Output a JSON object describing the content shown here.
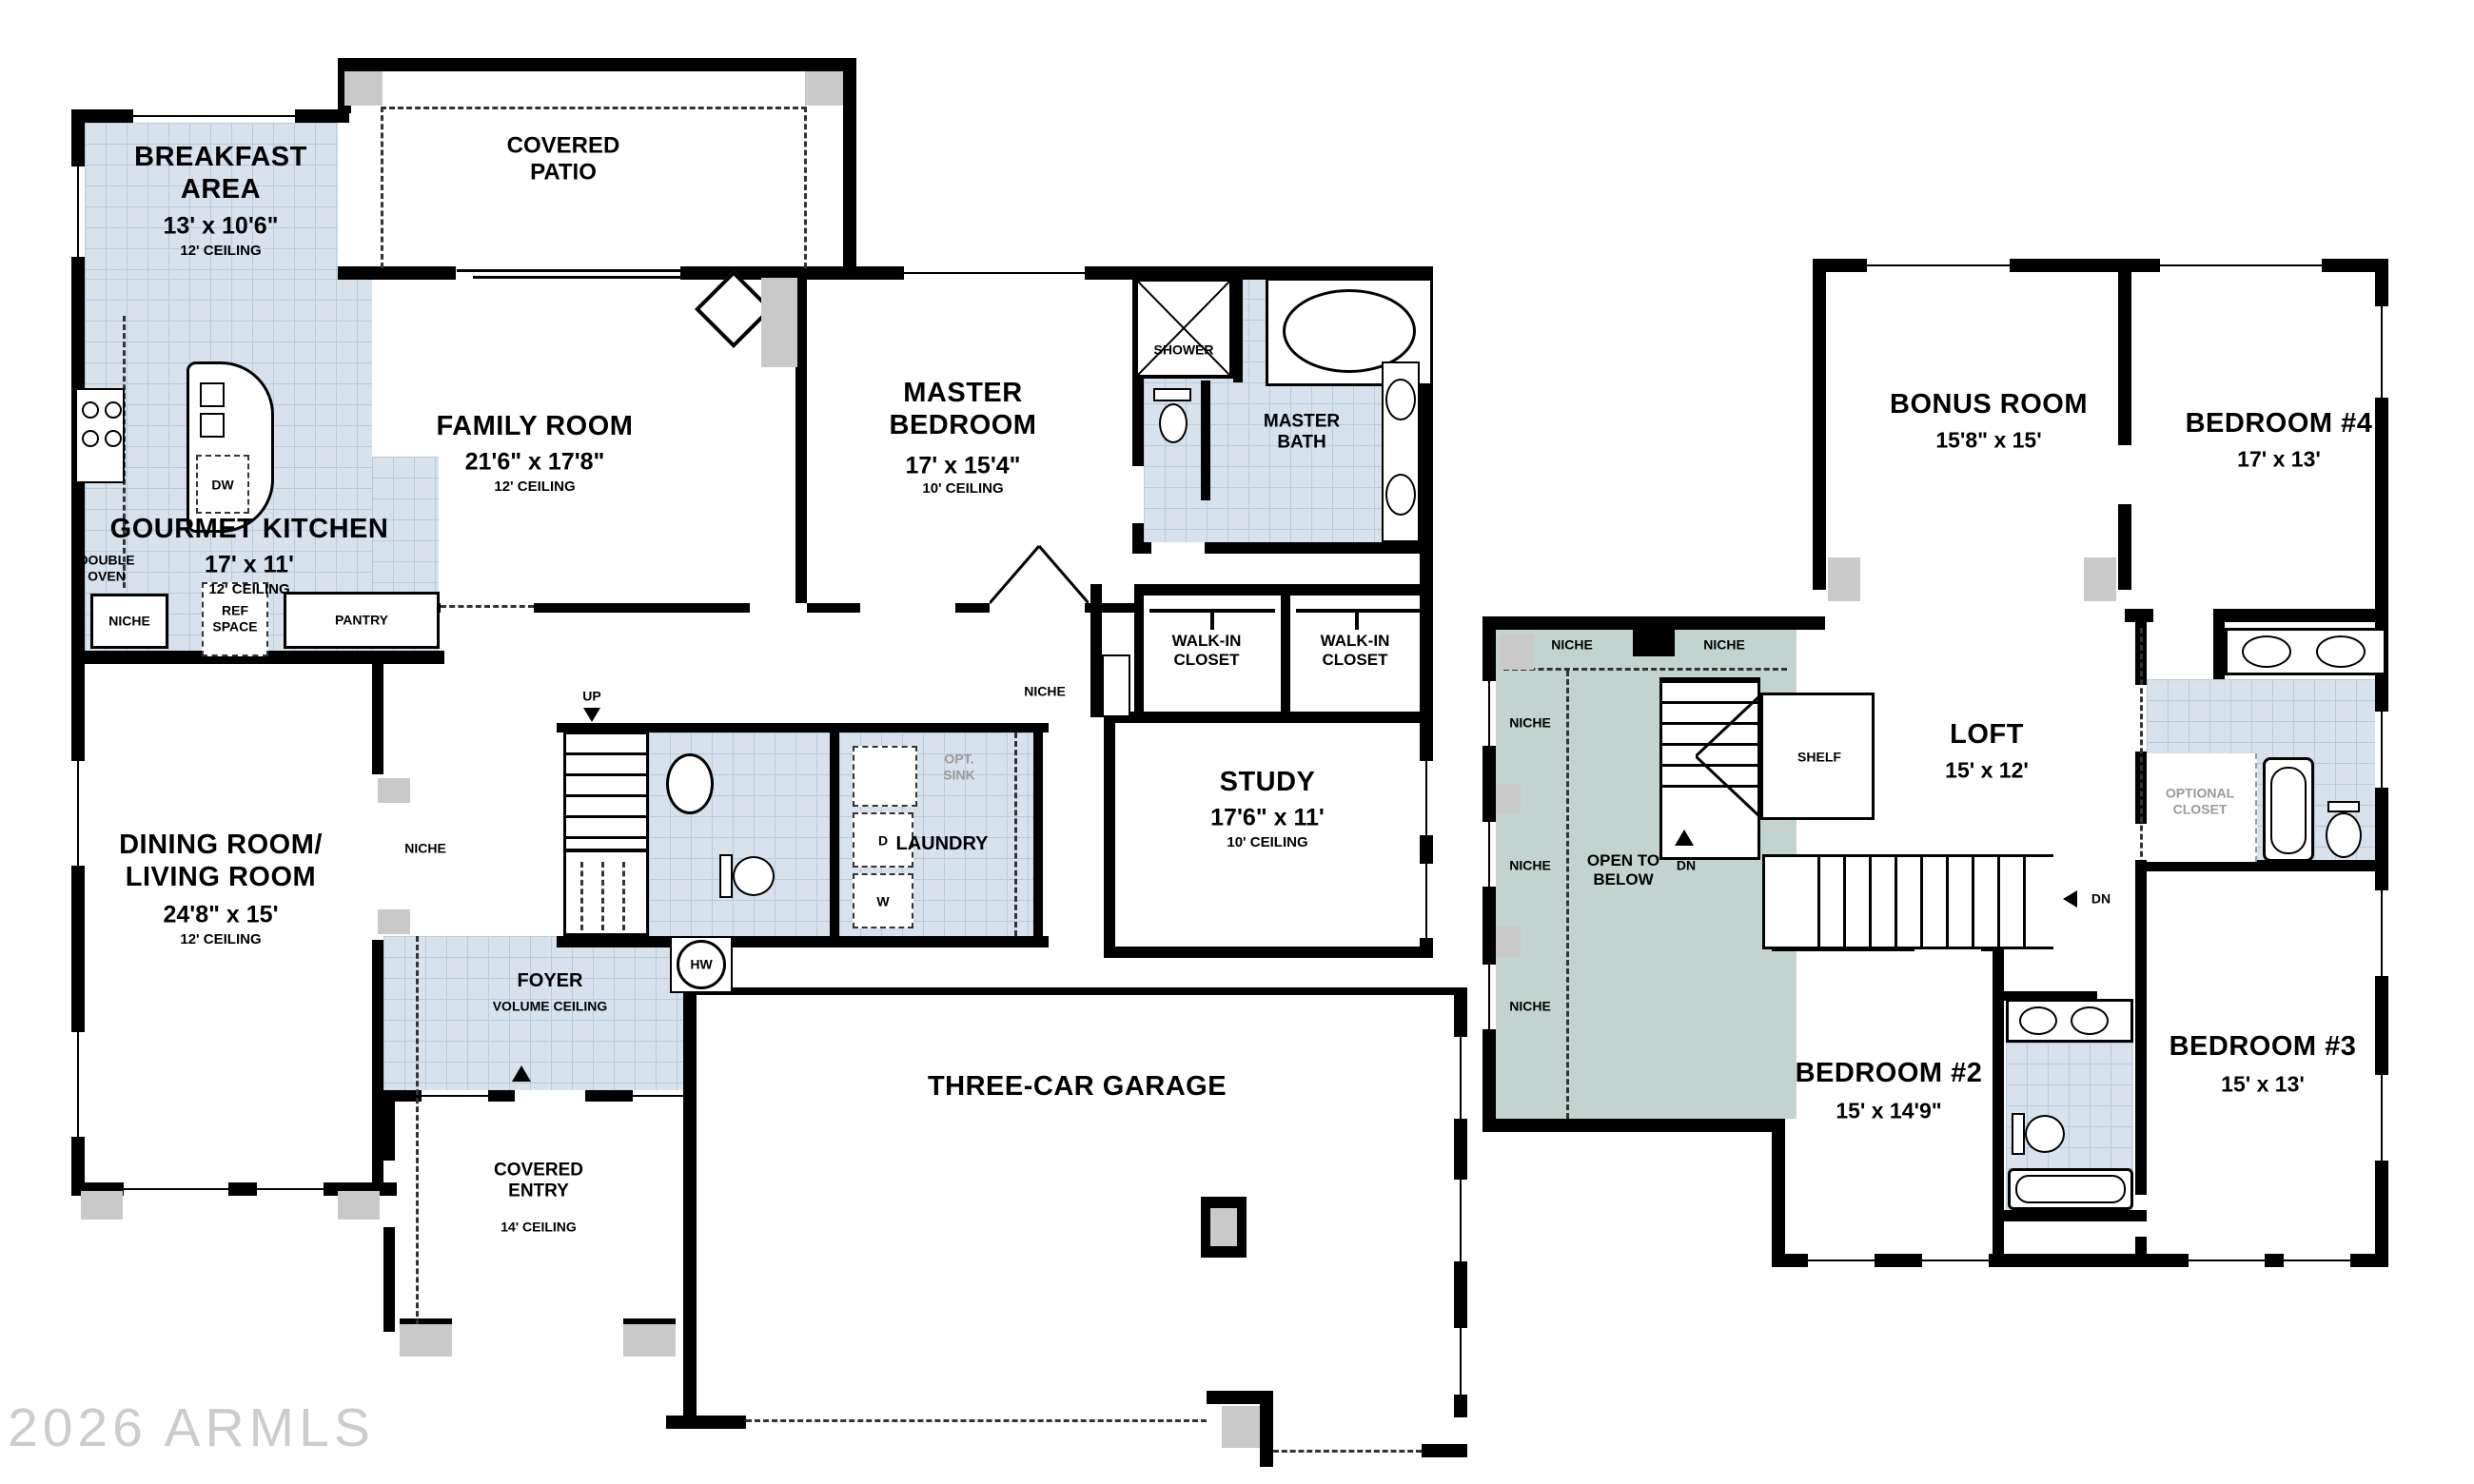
{
  "watermark": "2026 ARMLS",
  "colors": {
    "wall": "#000000",
    "tile_floor": "#d7e2ec",
    "tile_grid": "#b5cbd9",
    "open_to_below": "#c3d4d0",
    "post_gray": "#c9c9c9",
    "muted_label": "#999999",
    "background": "#ffffff"
  },
  "floor1": {
    "breakfast": {
      "name": "BREAKFAST\nAREA",
      "dims": "13' x 10'6\"",
      "ceiling": "12' CEILING"
    },
    "patio": {
      "name": "COVERED\nPATIO"
    },
    "family": {
      "name": "FAMILY ROOM",
      "dims": "21'6\" x 17'8\"",
      "ceiling": "12' CEILING"
    },
    "kitchen": {
      "name": "GOURMET KITCHEN",
      "dims": "17' x 11'",
      "ceiling": "12' CEILING"
    },
    "master": {
      "name": "MASTER\nBEDROOM",
      "dims": "17' x 15'4\"",
      "ceiling": "10' CEILING"
    },
    "master_bath": {
      "name": "MASTER\nBATH"
    },
    "shower": "SHOWER",
    "walkin": {
      "name": "WALK-IN\nCLOSET"
    },
    "dining": {
      "name": "DINING ROOM/\nLIVING ROOM",
      "dims": "24'8\" x 15'",
      "ceiling": "12' CEILING"
    },
    "study": {
      "name": "STUDY",
      "dims": "17'6\" x 11'",
      "ceiling": "10' CEILING"
    },
    "laundry": "LAUNDRY",
    "foyer": {
      "name": "FOYER",
      "sub": "VOLUME CEILING"
    },
    "entry": {
      "name": "COVERED\nENTRY",
      "ceiling": "14' CEILING"
    },
    "garage": {
      "name": "THREE-CAR GARAGE"
    },
    "tags": {
      "niche": "NICHE",
      "ref": "REF\nSPACE",
      "pantry": "PANTRY",
      "double_oven": "DOUBLE\nOVEN",
      "dw": "DW",
      "opt_sink": "OPT.\nSINK",
      "d": "D",
      "w": "W",
      "hw": "HW",
      "up": "UP"
    }
  },
  "floor2": {
    "bonus": {
      "name": "BONUS ROOM",
      "dims": "15'8\" x 15'"
    },
    "bed4": {
      "name": "BEDROOM #4",
      "dims": "17' x 13'"
    },
    "loft": {
      "name": "LOFT",
      "dims": "15' x 12'"
    },
    "open_below": {
      "name": "OPEN TO\nBELOW"
    },
    "bed2": {
      "name": "BEDROOM #2",
      "dims": "15' x 14'9\""
    },
    "bed3": {
      "name": "BEDROOM #3",
      "dims": "15' x 13'"
    },
    "tags": {
      "niche": "NICHE",
      "shelf": "SHELF",
      "dn": "DN",
      "optional_closet": "OPTIONAL\nCLOSET"
    }
  }
}
